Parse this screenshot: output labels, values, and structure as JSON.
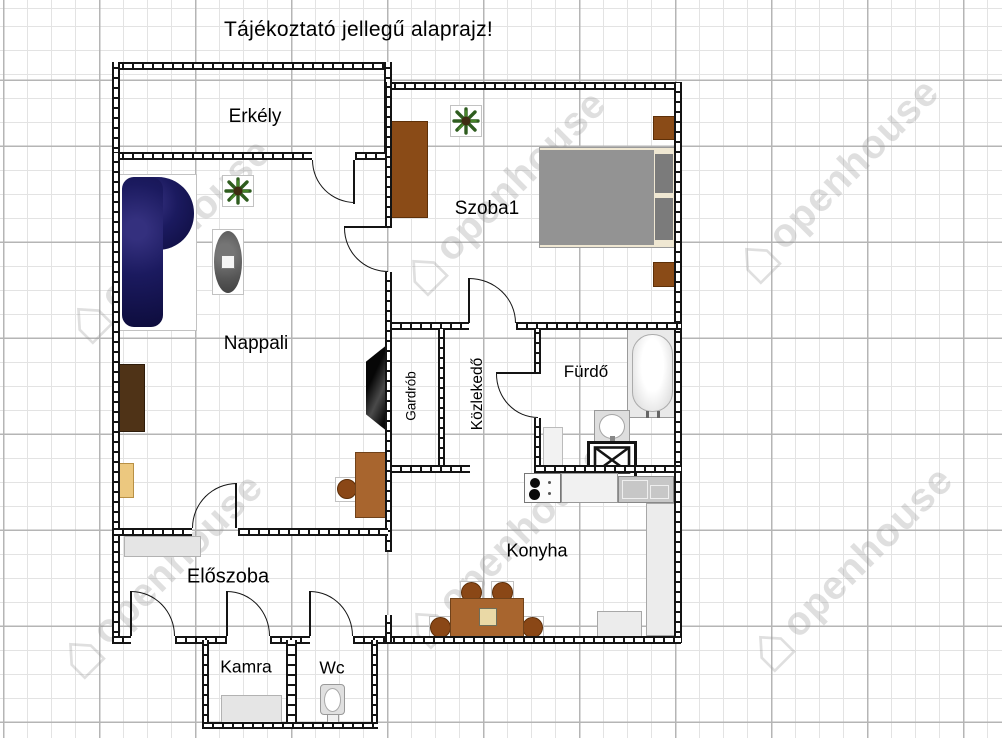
{
  "title": "Tájékoztató jellegű alaprajz!",
  "watermark": {
    "text": "openhouse"
  },
  "rooms": {
    "erkely": {
      "label": "Erkély"
    },
    "nappali": {
      "label": "Nappali"
    },
    "szoba1": {
      "label": "Szoba1"
    },
    "gardrob": {
      "label": "Gardrób"
    },
    "kozlekedo": {
      "label": "Közlekedő"
    },
    "furdo": {
      "label": "Fürdő"
    },
    "konyha": {
      "label": "Konyha"
    },
    "eloszoba": {
      "label": "Előszoba"
    },
    "kamra": {
      "label": "Kamra"
    },
    "wc": {
      "label": "Wc"
    }
  },
  "colors": {
    "wall": "#141414",
    "grid_major": "#b5b5b5",
    "grid_minor": "#e3e3e3",
    "sofa_navy": "#1b1a5f",
    "wood_light": "#a8652e",
    "wood_mid": "#8a4716",
    "wood_dark": "#4f3317",
    "bed_gray": "#939393",
    "fixture_gray": "#e9e9e9",
    "plant_green": "#2e5c1e"
  }
}
